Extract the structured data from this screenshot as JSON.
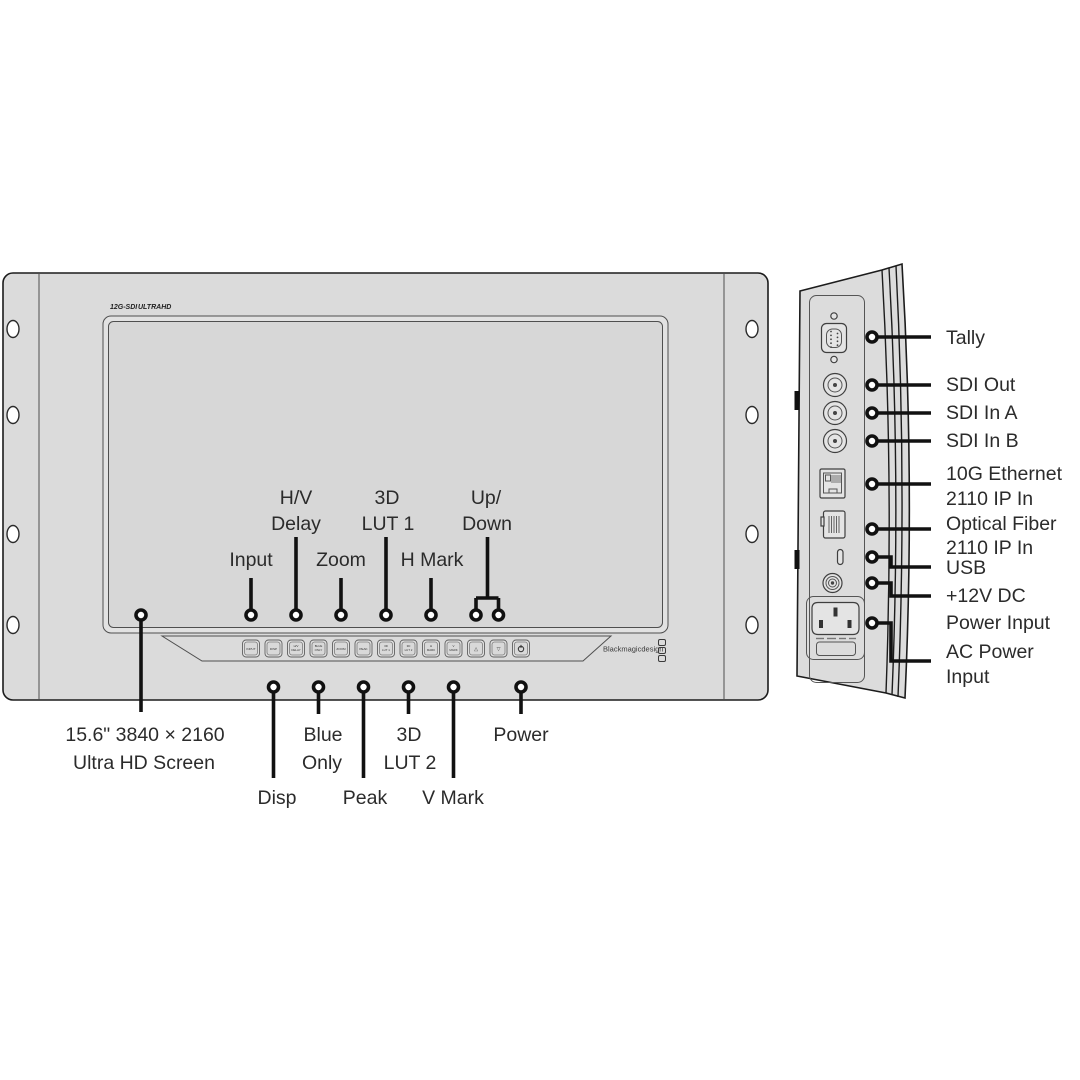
{
  "figure": {
    "front": {
      "logos": {
        "sdi12g": "12G-SDI",
        "ultrahd": "ULTRAHD"
      },
      "brand": "Blackmagicdesign",
      "buttons": {
        "input": "INPUT",
        "disp": "DISP",
        "hv1": "H/V",
        "hv2": "DELAY",
        "blue1": "BLUE",
        "blue2": "ONLY",
        "zoom": "ZOOM",
        "peak": "PEAK",
        "lut1a": "3D",
        "lut1b": "LUT 1",
        "lut2a": "3D",
        "lut2b": "LUT 2",
        "hm1": "H",
        "hm2": "MARK",
        "vm1": "V",
        "vm2": "MARK",
        "up": "△",
        "down": "▽"
      },
      "callouts": {
        "screen1": "15.6\" 3840 × 2160",
        "screen2": "Ultra HD Screen",
        "input": "Input",
        "hv1": "H/V",
        "hv2": "Delay",
        "zoom": "Zoom",
        "lut1a": "3D",
        "lut1b": "LUT 1",
        "hmark": "H Mark",
        "ud1": "Up/",
        "ud2": "Down",
        "disp": "Disp",
        "blue1": "Blue",
        "blue2": "Only",
        "peak": "Peak",
        "lut2a": "3D",
        "lut2b": "LUT 2",
        "vmark": "V Mark",
        "power": "Power"
      }
    },
    "rear": {
      "labels": {
        "tally": "Tally",
        "sdi_out": "SDI Out",
        "sdi_in_a": "SDI In A",
        "sdi_in_b": "SDI In B",
        "eth1": "10G Ethernet",
        "eth2": "2110 IP In",
        "fiber1": "Optical Fiber",
        "fiber2": "2110 IP In",
        "usb": "USB",
        "dc1": "+12V DC",
        "dc2": "Power Input",
        "ac1": "AC Power",
        "ac2": "Input"
      }
    },
    "icons": {
      "up_triangle": "△",
      "down_triangle": "▽",
      "power_symbol": "circle-with-bar"
    },
    "colors": {
      "background": "#ffffff",
      "panel_fill": "#dbdbdb",
      "outline": "#1c1c1c",
      "callout_line": "#111111",
      "label_text": "#2b2b2b"
    }
  }
}
